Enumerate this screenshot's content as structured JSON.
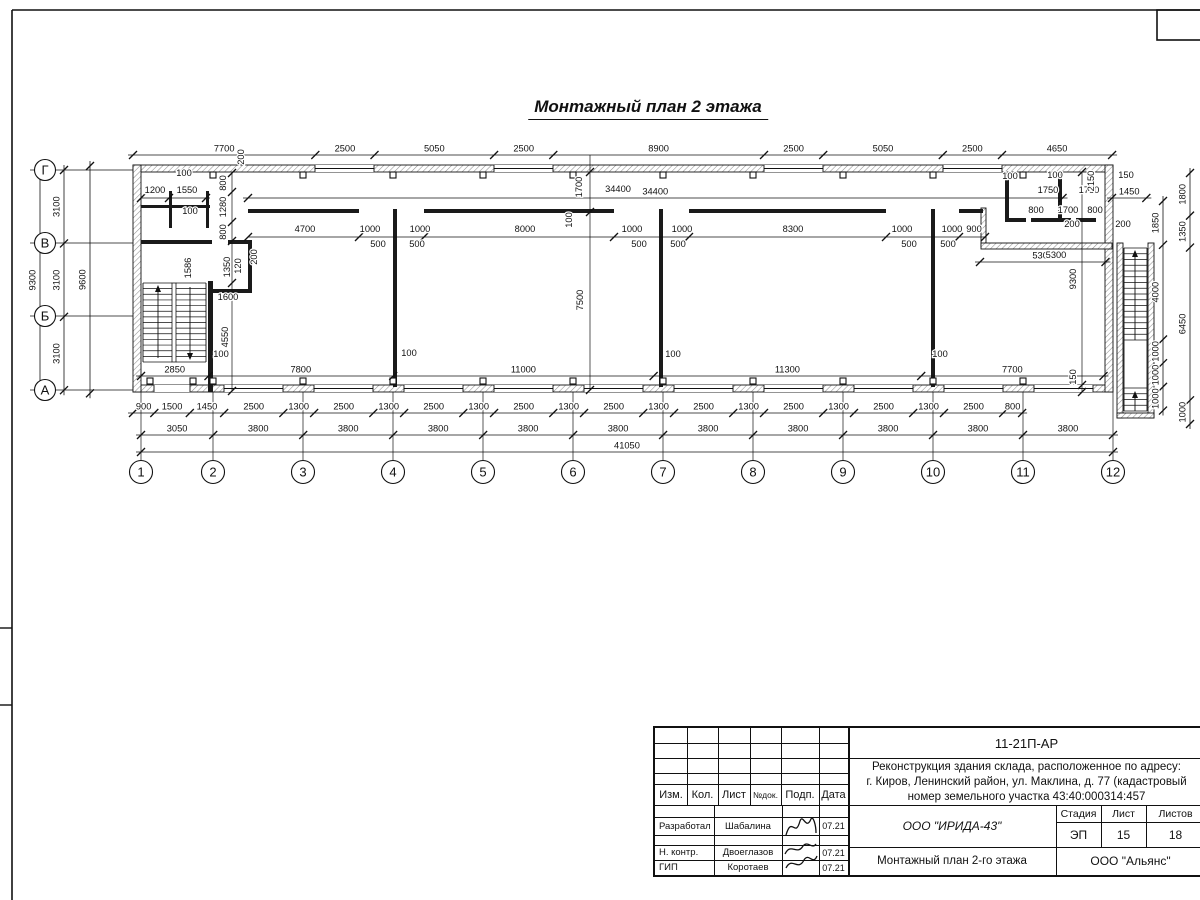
{
  "sheet": {
    "title": "Монтажный план 2 этажа",
    "line_color": "#111111",
    "hatch_color": "#8f8f8f"
  },
  "frame": {
    "top_y": 10,
    "left_x": 12,
    "margin_ticks_y": [
      628,
      705
    ],
    "corner_box": {
      "x": 1157,
      "y": 10,
      "w": 83,
      "h": 30
    }
  },
  "plan": {
    "px_per_mm": 0.023678,
    "axis_cols": {
      "labels": [
        "1",
        "2",
        "3",
        "4",
        "5",
        "6",
        "7",
        "8",
        "9",
        "10",
        "11",
        "12"
      ],
      "x": [
        141,
        213,
        303,
        393,
        483,
        573,
        663,
        753,
        843,
        933,
        1023,
        1113
      ],
      "bubble_y": 472,
      "line_y1": 392,
      "line_y2": 460,
      "r": 11.5
    },
    "axis_rows": {
      "labels": [
        "Г",
        "В",
        "Б",
        "А"
      ],
      "y": [
        170,
        243,
        316,
        390
      ],
      "bubble_x": 45,
      "line_x1": 30,
      "line_x2": 133,
      "r": 10.5
    },
    "dim_strings": [
      {
        "dir": "h",
        "x0": 133,
        "y": 155,
        "mm": [
          7700,
          2500,
          5050,
          2500,
          8900,
          2500,
          5050,
          2500,
          4650
        ]
      },
      {
        "dir": "h",
        "x0": 133,
        "y": 413,
        "mm": [
          900,
          1500,
          1450,
          2500,
          1300,
          2500,
          1300,
          2500,
          1300,
          2500,
          1300,
          2500,
          1300,
          2500,
          1300,
          2500,
          1300,
          2500,
          1300,
          2500,
          800
        ]
      },
      {
        "dir": "h",
        "x0": 141,
        "y": 435,
        "mm": [
          3050,
          3800,
          3800,
          3800,
          3800,
          3800,
          3800,
          3800,
          3800,
          3800,
          3800
        ]
      },
      {
        "dir": "h",
        "x0": 141,
        "y": 452,
        "mm": [
          41050
        ]
      },
      {
        "dir": "h",
        "x0": 141,
        "y": 376,
        "mm": [
          2850,
          7800,
          11000,
          11300,
          7700
        ]
      },
      {
        "dir": "h",
        "x0": 1112,
        "y": 198,
        "mm": [
          1450
        ]
      },
      {
        "dir": "h",
        "x0": 248,
        "y": 198,
        "mm": [
          34400
        ]
      },
      {
        "dir": "h",
        "x0": 980,
        "y": 262,
        "mm": [
          5300
        ]
      },
      {
        "dir": "v",
        "x": 40,
        "y0": 170,
        "mm": [
          9300
        ]
      },
      {
        "dir": "v",
        "x": 64,
        "y0": 170,
        "mm": [
          3100,
          3100,
          3100
        ]
      },
      {
        "dir": "v",
        "x": 90,
        "y0": 166,
        "mm": [
          9600
        ]
      },
      {
        "dir": "v",
        "x": 1163,
        "y0": 201,
        "mm": [
          1850,
          4000,
          1000,
          1000,
          1000
        ]
      },
      {
        "dir": "v",
        "x": 1190,
        "y0": 173,
        "mm": [
          1800,
          1350,
          6450,
          1000
        ]
      }
    ],
    "special_lines": [
      {
        "dir": "v",
        "pos": 232,
        "a": 173,
        "b": 391,
        "ticks": [
          173,
          192,
          222,
          241,
          283,
          391
        ]
      },
      {
        "dir": "v",
        "pos": 590,
        "a": 155,
        "b": 390,
        "ticks": [
          172,
          212,
          390
        ]
      },
      {
        "dir": "v",
        "pos": 1082,
        "a": 172,
        "b": 392,
        "ticks": [
          172,
          385,
          392
        ]
      },
      {
        "dir": "h",
        "pos": 237,
        "a": 248,
        "b": 985,
        "ticks": [
          248,
          359,
          424,
          614,
          689,
          886,
          959,
          985
        ]
      },
      {
        "dir": "h",
        "pos": 198,
        "a": 141,
        "b": 210,
        "ticks": [
          141,
          169,
          206
        ]
      }
    ],
    "labels": [
      {
        "t": "1200",
        "x": 155,
        "y": 193
      },
      {
        "t": "1550",
        "x": 187,
        "y": 193
      },
      {
        "t": "100",
        "x": 184,
        "y": 176
      },
      {
        "t": "100",
        "x": 190,
        "y": 214
      },
      {
        "t": "200",
        "x": 244,
        "y": 157,
        "r": -90
      },
      {
        "t": "800",
        "x": 226,
        "y": 183,
        "r": -90
      },
      {
        "t": "1280",
        "x": 226,
        "y": 207,
        "r": -90
      },
      {
        "t": "800",
        "x": 226,
        "y": 232,
        "r": -90
      },
      {
        "t": "1586",
        "x": 191,
        "y": 268,
        "r": -90
      },
      {
        "t": "1350",
        "x": 230,
        "y": 267,
        "r": -90
      },
      {
        "t": "120",
        "x": 241,
        "y": 266,
        "r": -90
      },
      {
        "t": "200",
        "x": 257,
        "y": 257,
        "r": -90
      },
      {
        "t": "1600",
        "x": 228,
        "y": 300
      },
      {
        "t": "4550",
        "x": 228,
        "y": 337,
        "r": -90
      },
      {
        "t": "100",
        "x": 221,
        "y": 357
      },
      {
        "t": "34400",
        "x": 618,
        "y": 192
      },
      {
        "t": "1700",
        "x": 582,
        "y": 187,
        "r": -90
      },
      {
        "t": "100",
        "x": 572,
        "y": 220,
        "r": -90
      },
      {
        "t": "7500",
        "x": 583,
        "y": 300,
        "r": -90
      },
      {
        "t": "4700",
        "x": 305,
        "y": 232
      },
      {
        "t": "1000",
        "x": 370,
        "y": 232
      },
      {
        "t": "1000",
        "x": 420,
        "y": 232
      },
      {
        "t": "500",
        "x": 378,
        "y": 247
      },
      {
        "t": "500",
        "x": 417,
        "y": 247
      },
      {
        "t": "8000",
        "x": 525,
        "y": 232
      },
      {
        "t": "1000",
        "x": 632,
        "y": 232
      },
      {
        "t": "1000",
        "x": 682,
        "y": 232
      },
      {
        "t": "500",
        "x": 639,
        "y": 247
      },
      {
        "t": "500",
        "x": 678,
        "y": 247
      },
      {
        "t": "8300",
        "x": 793,
        "y": 232
      },
      {
        "t": "1000",
        "x": 902,
        "y": 232
      },
      {
        "t": "1000",
        "x": 952,
        "y": 232
      },
      {
        "t": "900",
        "x": 974,
        "y": 232
      },
      {
        "t": "500",
        "x": 909,
        "y": 247
      },
      {
        "t": "500",
        "x": 948,
        "y": 247
      },
      {
        "t": "5300",
        "x": 1056,
        "y": 258
      },
      {
        "t": "100",
        "x": 409,
        "y": 356
      },
      {
        "t": "100",
        "x": 673,
        "y": 357
      },
      {
        "t": "100",
        "x": 940,
        "y": 357
      },
      {
        "t": "9300",
        "x": 1076,
        "y": 279,
        "r": -90
      },
      {
        "t": "150",
        "x": 1076,
        "y": 377,
        "r": -90
      },
      {
        "t": "100",
        "x": 1010,
        "y": 179
      },
      {
        "t": "100",
        "x": 1055,
        "y": 178
      },
      {
        "t": "1750",
        "x": 1048,
        "y": 193
      },
      {
        "t": "1750",
        "x": 1089,
        "y": 193
      },
      {
        "t": "2150",
        "x": 1094,
        "y": 181,
        "r": -90
      },
      {
        "t": "150",
        "x": 1126,
        "y": 178
      },
      {
        "t": "800",
        "x": 1036,
        "y": 213
      },
      {
        "t": "1700",
        "x": 1068,
        "y": 213
      },
      {
        "t": "800",
        "x": 1095,
        "y": 213
      },
      {
        "t": "200",
        "x": 1072,
        "y": 227
      },
      {
        "t": "200",
        "x": 1123,
        "y": 227
      }
    ],
    "walls_ext": [
      {
        "x": 133,
        "y": 165,
        "w": 980,
        "h": 7
      },
      {
        "x": 133,
        "y": 385,
        "w": 980,
        "h": 7
      },
      {
        "x": 133,
        "y": 165,
        "w": 8,
        "h": 227
      },
      {
        "x": 1105,
        "y": 165,
        "w": 8,
        "h": 227
      },
      {
        "x": 981,
        "y": 208,
        "w": 5,
        "h": 39
      },
      {
        "x": 981,
        "y": 243,
        "w": 131,
        "h": 6
      },
      {
        "x": 1117,
        "y": 243,
        "w": 6,
        "h": 175
      },
      {
        "x": 1148,
        "y": 243,
        "w": 6,
        "h": 175
      },
      {
        "x": 1117,
        "y": 413,
        "w": 37,
        "h": 5
      }
    ],
    "walls_int": [
      {
        "x": 248,
        "y": 209,
        "w": 111,
        "h": 4
      },
      {
        "x": 424,
        "y": 209,
        "w": 190,
        "h": 4
      },
      {
        "x": 689,
        "y": 209,
        "w": 197,
        "h": 4
      },
      {
        "x": 959,
        "y": 209,
        "w": 24,
        "h": 4
      },
      {
        "x": 393,
        "y": 209,
        "w": 4,
        "h": 178
      },
      {
        "x": 659,
        "y": 209,
        "w": 4,
        "h": 178
      },
      {
        "x": 931,
        "y": 209,
        "w": 4,
        "h": 178
      },
      {
        "x": 141,
        "y": 205,
        "w": 69,
        "h": 3
      },
      {
        "x": 169,
        "y": 191,
        "w": 3,
        "h": 37
      },
      {
        "x": 206,
        "y": 191,
        "w": 3,
        "h": 37
      },
      {
        "x": 141,
        "y": 240,
        "w": 71,
        "h": 4
      },
      {
        "x": 228,
        "y": 240,
        "w": 24,
        "h": 4
      },
      {
        "x": 248,
        "y": 243,
        "w": 4,
        "h": 50
      },
      {
        "x": 213,
        "y": 289,
        "w": 39,
        "h": 4
      },
      {
        "x": 208,
        "y": 281,
        "w": 5,
        "h": 111
      },
      {
        "x": 1005,
        "y": 173,
        "w": 4,
        "h": 49
      },
      {
        "x": 1058,
        "y": 173,
        "w": 4,
        "h": 49
      },
      {
        "x": 1005,
        "y": 218,
        "w": 21,
        "h": 4
      },
      {
        "x": 1031,
        "y": 218,
        "w": 40,
        "h": 4
      },
      {
        "x": 1076,
        "y": 218,
        "w": 20,
        "h": 4
      }
    ],
    "windows_top": {
      "y": 165,
      "h": 7,
      "w": 59,
      "x": [
        315,
        494,
        764,
        943
      ]
    },
    "windows_bottom": {
      "y": 385,
      "h": 7,
      "w": 59,
      "x": [
        224,
        314,
        404,
        494,
        584,
        674,
        764,
        854,
        944,
        1034
      ]
    },
    "door_bottom": {
      "x": 154,
      "y": 385,
      "w": 36,
      "h": 7
    },
    "squares_top": {
      "y": 172,
      "x": [
        213,
        303,
        393,
        483,
        573,
        663,
        753,
        843,
        933,
        1023
      ]
    },
    "squares_bottom": {
      "y": 378,
      "x": [
        150,
        193,
        213,
        303,
        393,
        483,
        573,
        663,
        753,
        843,
        933,
        1023
      ]
    },
    "stair_left": {
      "x1": 143,
      "x2": 206,
      "mid": 174,
      "y1": 283,
      "y2": 362,
      "treads": 14,
      "arrow_up_x": 158,
      "arrow_down_x": 190
    },
    "stair_right": {
      "x1": 1124,
      "x2": 1147,
      "y1": 248,
      "y2": 340,
      "treads": 16,
      "y3": 388,
      "y4": 411,
      "treads2": 4,
      "arrow_x": 1135
    }
  },
  "title_block": {
    "code": "11-21П-АР",
    "desc_line1": "Реконструкция здания склада, расположенное по адресу:",
    "desc_line2": "г. Киров, Ленинский район, ул. Маклина, д. 77 (кадастровый",
    "desc_line3": "номер земельного участка 43:40:000314:457",
    "col_izm": "Изм.",
    "col_kol": "Кол.",
    "col_list": "Лист",
    "col_ndok": "№док.",
    "col_podp": "Подп.",
    "col_data": "Дата",
    "stadia_label": "Стадия",
    "list_label": "Лист",
    "listov_label": "Листов",
    "stadia": "ЭП",
    "list_num": "15",
    "listov": "18",
    "org": "ООО \"ИРИДА-43\"",
    "drawing_name": "Монтажный план 2-го этажа",
    "company": "ООО \"Альянс\"",
    "row1_role": "Разработал",
    "row1_name": "Шабалина",
    "row1_date": "07.21",
    "row2_role": "Н. контр.",
    "row2_name": "Двоеглазов",
    "row2_date": "07.21",
    "row3_role": "ГИП",
    "row3_name": "Коротаев",
    "row3_date": "07.21"
  }
}
